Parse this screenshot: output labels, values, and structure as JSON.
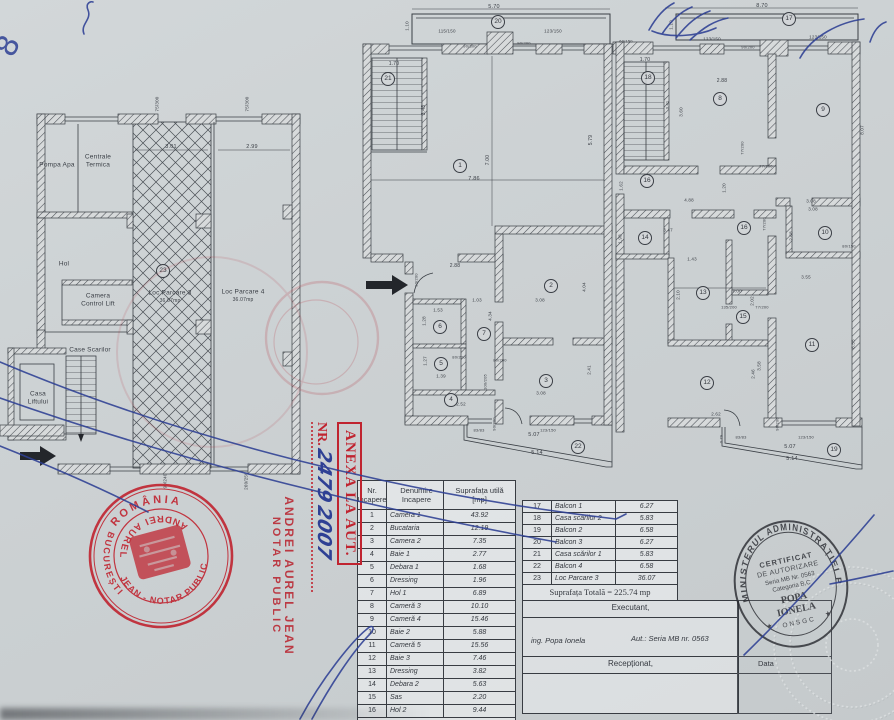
{
  "colors": {
    "paper": "#ccd1d3",
    "ink": "#34383f",
    "stamp_red": "#c02430",
    "pen_blue": "#2e4094",
    "certificate_ink": "#2b2d33"
  },
  "plans": {
    "left": {
      "labels": [
        {
          "t": "Pompa Apa",
          "x": 57,
          "y": 165,
          "fs": 6.5
        },
        {
          "t": "Centrale",
          "x": 98,
          "y": 157,
          "fs": 6.5
        },
        {
          "t": "Termica",
          "x": 98,
          "y": 165,
          "fs": 6.5
        },
        {
          "t": "Hol",
          "x": 64,
          "y": 264,
          "fs": 6.5
        },
        {
          "t": "Camera",
          "x": 98,
          "y": 296,
          "fs": 6.5
        },
        {
          "t": "Control Lift",
          "x": 98,
          "y": 304,
          "fs": 6.5
        },
        {
          "t": "Case Scarilor",
          "x": 90,
          "y": 350,
          "fs": 6.5
        },
        {
          "t": "Casa",
          "x": 38,
          "y": 394,
          "fs": 6.5
        },
        {
          "t": "Liftului",
          "x": 38,
          "y": 402,
          "fs": 6.5
        },
        {
          "t": "Loc Parcare 3",
          "x": 170,
          "y": 293,
          "fs": 6.5
        },
        {
          "t": "36.07mp",
          "x": 170,
          "y": 301,
          "fs": 5
        },
        {
          "t": "Loc Parcare 4",
          "x": 243,
          "y": 292,
          "fs": 6.5
        },
        {
          "t": "36.07mp",
          "x": 243,
          "y": 300,
          "fs": 5
        }
      ],
      "dims": [
        {
          "t": "75/300",
          "x": 157,
          "y": 104,
          "fs": 4.5,
          "v": true
        },
        {
          "t": "75/300",
          "x": 247,
          "y": 104,
          "fs": 4.5,
          "v": true
        },
        {
          "t": "3.01",
          "x": 171,
          "y": 147,
          "fs": 5.5
        },
        {
          "t": "2.99",
          "x": 252,
          "y": 147,
          "fs": 5.5
        },
        {
          "t": "90/240",
          "x": 165,
          "y": 481,
          "fs": 4.5,
          "v": true
        },
        {
          "t": "260/250",
          "x": 246,
          "y": 481,
          "fs": 4.5,
          "v": true
        }
      ],
      "circles": [
        {
          "n": "23",
          "x": 163,
          "y": 271
        }
      ]
    },
    "middle": {
      "labels": [],
      "dims": [
        {
          "t": "5.70",
          "x": 494,
          "y": 7,
          "fs": 5.5
        },
        {
          "t": "1.10",
          "x": 407,
          "y": 26,
          "fs": 4.5,
          "v": true
        },
        {
          "t": "115/150",
          "x": 447,
          "y": 31,
          "fs": 4.5
        },
        {
          "t": "90/300",
          "x": 470,
          "y": 46,
          "fs": 4
        },
        {
          "t": "90/200",
          "x": 524,
          "y": 43,
          "fs": 4
        },
        {
          "t": "123/150",
          "x": 553,
          "y": 31,
          "fs": 4.5
        },
        {
          "t": "1.70",
          "x": 394,
          "y": 64,
          "fs": 5
        },
        {
          "t": "3.43",
          "x": 424,
          "y": 110,
          "fs": 5,
          "v": true
        },
        {
          "t": "7.00",
          "x": 488,
          "y": 160,
          "fs": 5,
          "v": true
        },
        {
          "t": "7.86",
          "x": 474,
          "y": 179,
          "fs": 5.5
        },
        {
          "t": "5.79",
          "x": 591,
          "y": 140,
          "fs": 5,
          "v": true
        },
        {
          "t": "2.88",
          "x": 455,
          "y": 266,
          "fs": 5
        },
        {
          "t": "90/200",
          "x": 416,
          "y": 280,
          "fs": 4,
          "v": true
        },
        {
          "t": "1.03",
          "x": 477,
          "y": 300,
          "fs": 4.5
        },
        {
          "t": "3.08",
          "x": 540,
          "y": 300,
          "fs": 4.5
        },
        {
          "t": "1.53",
          "x": 438,
          "y": 310,
          "fs": 4.5
        },
        {
          "t": "4.34",
          "x": 490,
          "y": 316,
          "fs": 4.5,
          "v": true
        },
        {
          "t": "4.04",
          "x": 584,
          "y": 287,
          "fs": 4.5,
          "v": true
        },
        {
          "t": "1.28",
          "x": 424,
          "y": 321,
          "fs": 4.5,
          "v": true
        },
        {
          "t": "1.27",
          "x": 425,
          "y": 361,
          "fs": 4.5,
          "v": true
        },
        {
          "t": "80/200",
          "x": 459,
          "y": 357,
          "fs": 4
        },
        {
          "t": "80/200",
          "x": 500,
          "y": 360,
          "fs": 4
        },
        {
          "t": "1.39",
          "x": 441,
          "y": 376,
          "fs": 4.5
        },
        {
          "t": "100/205",
          "x": 485,
          "y": 382,
          "fs": 4,
          "v": true
        },
        {
          "t": "2.41",
          "x": 589,
          "y": 370,
          "fs": 4.5,
          "v": true
        },
        {
          "t": "3.08",
          "x": 541,
          "y": 393,
          "fs": 4.5
        },
        {
          "t": "2.52",
          "x": 461,
          "y": 404,
          "fs": 4.5
        },
        {
          "t": "90/200",
          "x": 494,
          "y": 424,
          "fs": 4,
          "v": true
        },
        {
          "t": "83/83",
          "x": 479,
          "y": 430,
          "fs": 4
        },
        {
          "t": "123/150",
          "x": 548,
          "y": 430,
          "fs": 4
        },
        {
          "t": "5.07",
          "x": 534,
          "y": 435,
          "fs": 5.5
        },
        {
          "t": "5.14",
          "x": 537,
          "y": 453,
          "fs": 5.5
        }
      ],
      "circles": [
        {
          "n": "20",
          "x": 498,
          "y": 22
        },
        {
          "n": "21",
          "x": 388,
          "y": 79
        },
        {
          "n": "1",
          "x": 460,
          "y": 166
        },
        {
          "n": "2",
          "x": 551,
          "y": 286
        },
        {
          "n": "6",
          "x": 440,
          "y": 327
        },
        {
          "n": "7",
          "x": 484,
          "y": 334
        },
        {
          "n": "5",
          "x": 441,
          "y": 364
        },
        {
          "n": "3",
          "x": 546,
          "y": 381
        },
        {
          "n": "4",
          "x": 451,
          "y": 400
        },
        {
          "n": "22",
          "x": 578,
          "y": 447
        }
      ]
    },
    "right": {
      "labels": [],
      "dims": [
        {
          "t": "8.70",
          "x": 762,
          "y": 6,
          "fs": 5.5
        },
        {
          "t": "1.10",
          "x": 671,
          "y": 25,
          "fs": 4.5,
          "v": true
        },
        {
          "t": "60/150",
          "x": 626,
          "y": 41,
          "fs": 4
        },
        {
          "t": "123/150",
          "x": 712,
          "y": 39,
          "fs": 4.5
        },
        {
          "t": "90/200",
          "x": 748,
          "y": 47,
          "fs": 4
        },
        {
          "t": "123/150",
          "x": 818,
          "y": 37,
          "fs": 4.5
        },
        {
          "t": "1.70",
          "x": 645,
          "y": 60,
          "fs": 5
        },
        {
          "t": "2.88",
          "x": 722,
          "y": 81,
          "fs": 5
        },
        {
          "t": "0.41",
          "x": 667,
          "y": 105,
          "fs": 4,
          "v": true
        },
        {
          "t": "3.60",
          "x": 681,
          "y": 112,
          "fs": 4.5,
          "v": true
        },
        {
          "t": "8.07",
          "x": 862,
          "y": 130,
          "fs": 4.5,
          "v": true
        },
        {
          "t": "77/200",
          "x": 742,
          "y": 148,
          "fs": 4,
          "v": true
        },
        {
          "t": "77/200",
          "x": 766,
          "y": 166,
          "fs": 4
        },
        {
          "t": "1.62",
          "x": 621,
          "y": 186,
          "fs": 4.5,
          "v": true
        },
        {
          "t": "1.20",
          "x": 724,
          "y": 188,
          "fs": 4.5,
          "v": true
        },
        {
          "t": "4.88",
          "x": 689,
          "y": 200,
          "fs": 4.5
        },
        {
          "t": "3.08",
          "x": 811,
          "y": 201,
          "fs": 4.5
        },
        {
          "t": "3.08",
          "x": 813,
          "y": 209,
          "fs": 4.5
        },
        {
          "t": "3.47",
          "x": 668,
          "y": 230,
          "fs": 4.5
        },
        {
          "t": "1.98",
          "x": 620,
          "y": 239,
          "fs": 4.5,
          "v": true
        },
        {
          "t": "77/200",
          "x": 764,
          "y": 224,
          "fs": 4,
          "v": true
        },
        {
          "t": "2.68",
          "x": 791,
          "y": 236,
          "fs": 4.5,
          "v": true
        },
        {
          "t": "80/150",
          "x": 849,
          "y": 246,
          "fs": 4
        },
        {
          "t": "1.43",
          "x": 692,
          "y": 259,
          "fs": 4.5
        },
        {
          "t": "2.10",
          "x": 678,
          "y": 295,
          "fs": 4.5,
          "v": true
        },
        {
          "t": "7.00",
          "x": 737,
          "y": 291,
          "fs": 4.5
        },
        {
          "t": "2.02",
          "x": 752,
          "y": 301,
          "fs": 4.5,
          "v": true
        },
        {
          "t": "135/200",
          "x": 729,
          "y": 307,
          "fs": 4
        },
        {
          "t": "77/200",
          "x": 762,
          "y": 307,
          "fs": 4
        },
        {
          "t": "3.55",
          "x": 806,
          "y": 277,
          "fs": 4.5
        },
        {
          "t": "3.58",
          "x": 759,
          "y": 366,
          "fs": 4.5,
          "v": true
        },
        {
          "t": "2.46",
          "x": 753,
          "y": 374,
          "fs": 4.5,
          "v": true
        },
        {
          "t": "6.55",
          "x": 853,
          "y": 344,
          "fs": 4.5,
          "v": true
        },
        {
          "t": "2.62",
          "x": 716,
          "y": 414,
          "fs": 4.5
        },
        {
          "t": "90/200",
          "x": 777,
          "y": 424,
          "fs": 4,
          "v": true
        },
        {
          "t": "0.79",
          "x": 721,
          "y": 439,
          "fs": 4,
          "v": true
        },
        {
          "t": "83/83",
          "x": 741,
          "y": 437,
          "fs": 4
        },
        {
          "t": "123/150",
          "x": 806,
          "y": 437,
          "fs": 4
        },
        {
          "t": "5.07",
          "x": 790,
          "y": 447,
          "fs": 5.5
        },
        {
          "t": "5.14",
          "x": 792,
          "y": 459,
          "fs": 5.5
        }
      ],
      "circles": [
        {
          "n": "17",
          "x": 789,
          "y": 19
        },
        {
          "n": "18",
          "x": 648,
          "y": 78
        },
        {
          "n": "8",
          "x": 720,
          "y": 99
        },
        {
          "n": "9",
          "x": 823,
          "y": 110
        },
        {
          "n": "16",
          "x": 647,
          "y": 181
        },
        {
          "n": "16",
          "x": 744,
          "y": 228
        },
        {
          "n": "14",
          "x": 645,
          "y": 238
        },
        {
          "n": "10",
          "x": 825,
          "y": 233
        },
        {
          "n": "13",
          "x": 703,
          "y": 293
        },
        {
          "n": "15",
          "x": 743,
          "y": 317
        },
        {
          "n": "11",
          "x": 812,
          "y": 345
        },
        {
          "n": "12",
          "x": 707,
          "y": 383
        },
        {
          "n": "19",
          "x": 834,
          "y": 450
        }
      ]
    }
  },
  "tables": {
    "rooms": {
      "header": {
        "c0": [
          "Nr.",
          "Incapere"
        ],
        "c1": [
          "Denumire",
          "Incapere"
        ],
        "c2": [
          "Suprafața utilă",
          "[mp]"
        ]
      },
      "rows": [
        [
          "1",
          "Camera 1",
          "43.92"
        ],
        [
          "2",
          "Bucataria",
          "12.19"
        ],
        [
          "3",
          "Camera 2",
          "7.35"
        ],
        [
          "4",
          "Baie 1",
          "2.77"
        ],
        [
          "5",
          "Debara 1",
          "1.68"
        ],
        [
          "6",
          "Dressing",
          "1.96"
        ],
        [
          "7",
          "Hol 1",
          "6.89"
        ],
        [
          "8",
          "Cameră 3",
          "10.10"
        ],
        [
          "9",
          "Cameră 4",
          "15.46"
        ],
        [
          "10",
          "Baie 2",
          "5.88"
        ],
        [
          "11",
          "Cameră 5",
          "15.56"
        ],
        [
          "12",
          "Baie 3",
          "7.46"
        ],
        [
          "13",
          "Dressing",
          "3.82"
        ],
        [
          "14",
          "Debara 2",
          "5.63"
        ],
        [
          "15",
          "Sas",
          "2.20"
        ],
        [
          "16",
          "Hol 2",
          "9.44"
        ]
      ],
      "footer": "Suprafața Utilă = 152.31 mp"
    },
    "annex": {
      "rows": [
        [
          "17",
          "Balcon 1",
          "6.27"
        ],
        [
          "18",
          "Casa scărilor 2",
          "5.83"
        ],
        [
          "19",
          "Balcon 2",
          "6.58"
        ],
        [
          "20",
          "Balcon 3",
          "6.27"
        ],
        [
          "21",
          "Casa scărilor 1",
          "5.83"
        ],
        [
          "22",
          "Balcon 4",
          "6.58"
        ],
        [
          "23",
          "Loc Parcare 3",
          "36.07"
        ]
      ],
      "footer": "Suprafața Totală = 225.74 mp"
    }
  },
  "executant": {
    "title": "Executant,",
    "name": "ing. Popa Ionela",
    "autorization": "Aut.: Seria MB nr. 0563",
    "received": "Recepționat,",
    "data_label": "Data"
  },
  "stamps": {
    "notary_round": {
      "top": "ROMÂNIA",
      "left": "BUCUREȘTI",
      "inner_top": "ANDREI AUREL",
      "inner_bottom": "JEAN - NOTAR PUBLIC"
    },
    "notary_lines": {
      "l1": "ANDREI AUREL JEAN",
      "l2": "NOTAR PUBLIC"
    },
    "annex_box": {
      "title": "ANEXA LA AUT.",
      "nr_label": "NR.",
      "number": "2479",
      "year": "2007"
    },
    "certificate": {
      "ring": "MINISTERUL ADMINISTRAȚIEI PUBLICE",
      "l1": "CERTIFICAT",
      "l2": "DE AUTORIZARE",
      "l3": "Seria MB Nr. 0563",
      "l4": "Categoria B,C",
      "l5": "POPA",
      "l6": "IONELA",
      "l7": "ONSGC",
      "star": "★"
    }
  },
  "pen": {
    "figure": "8"
  }
}
